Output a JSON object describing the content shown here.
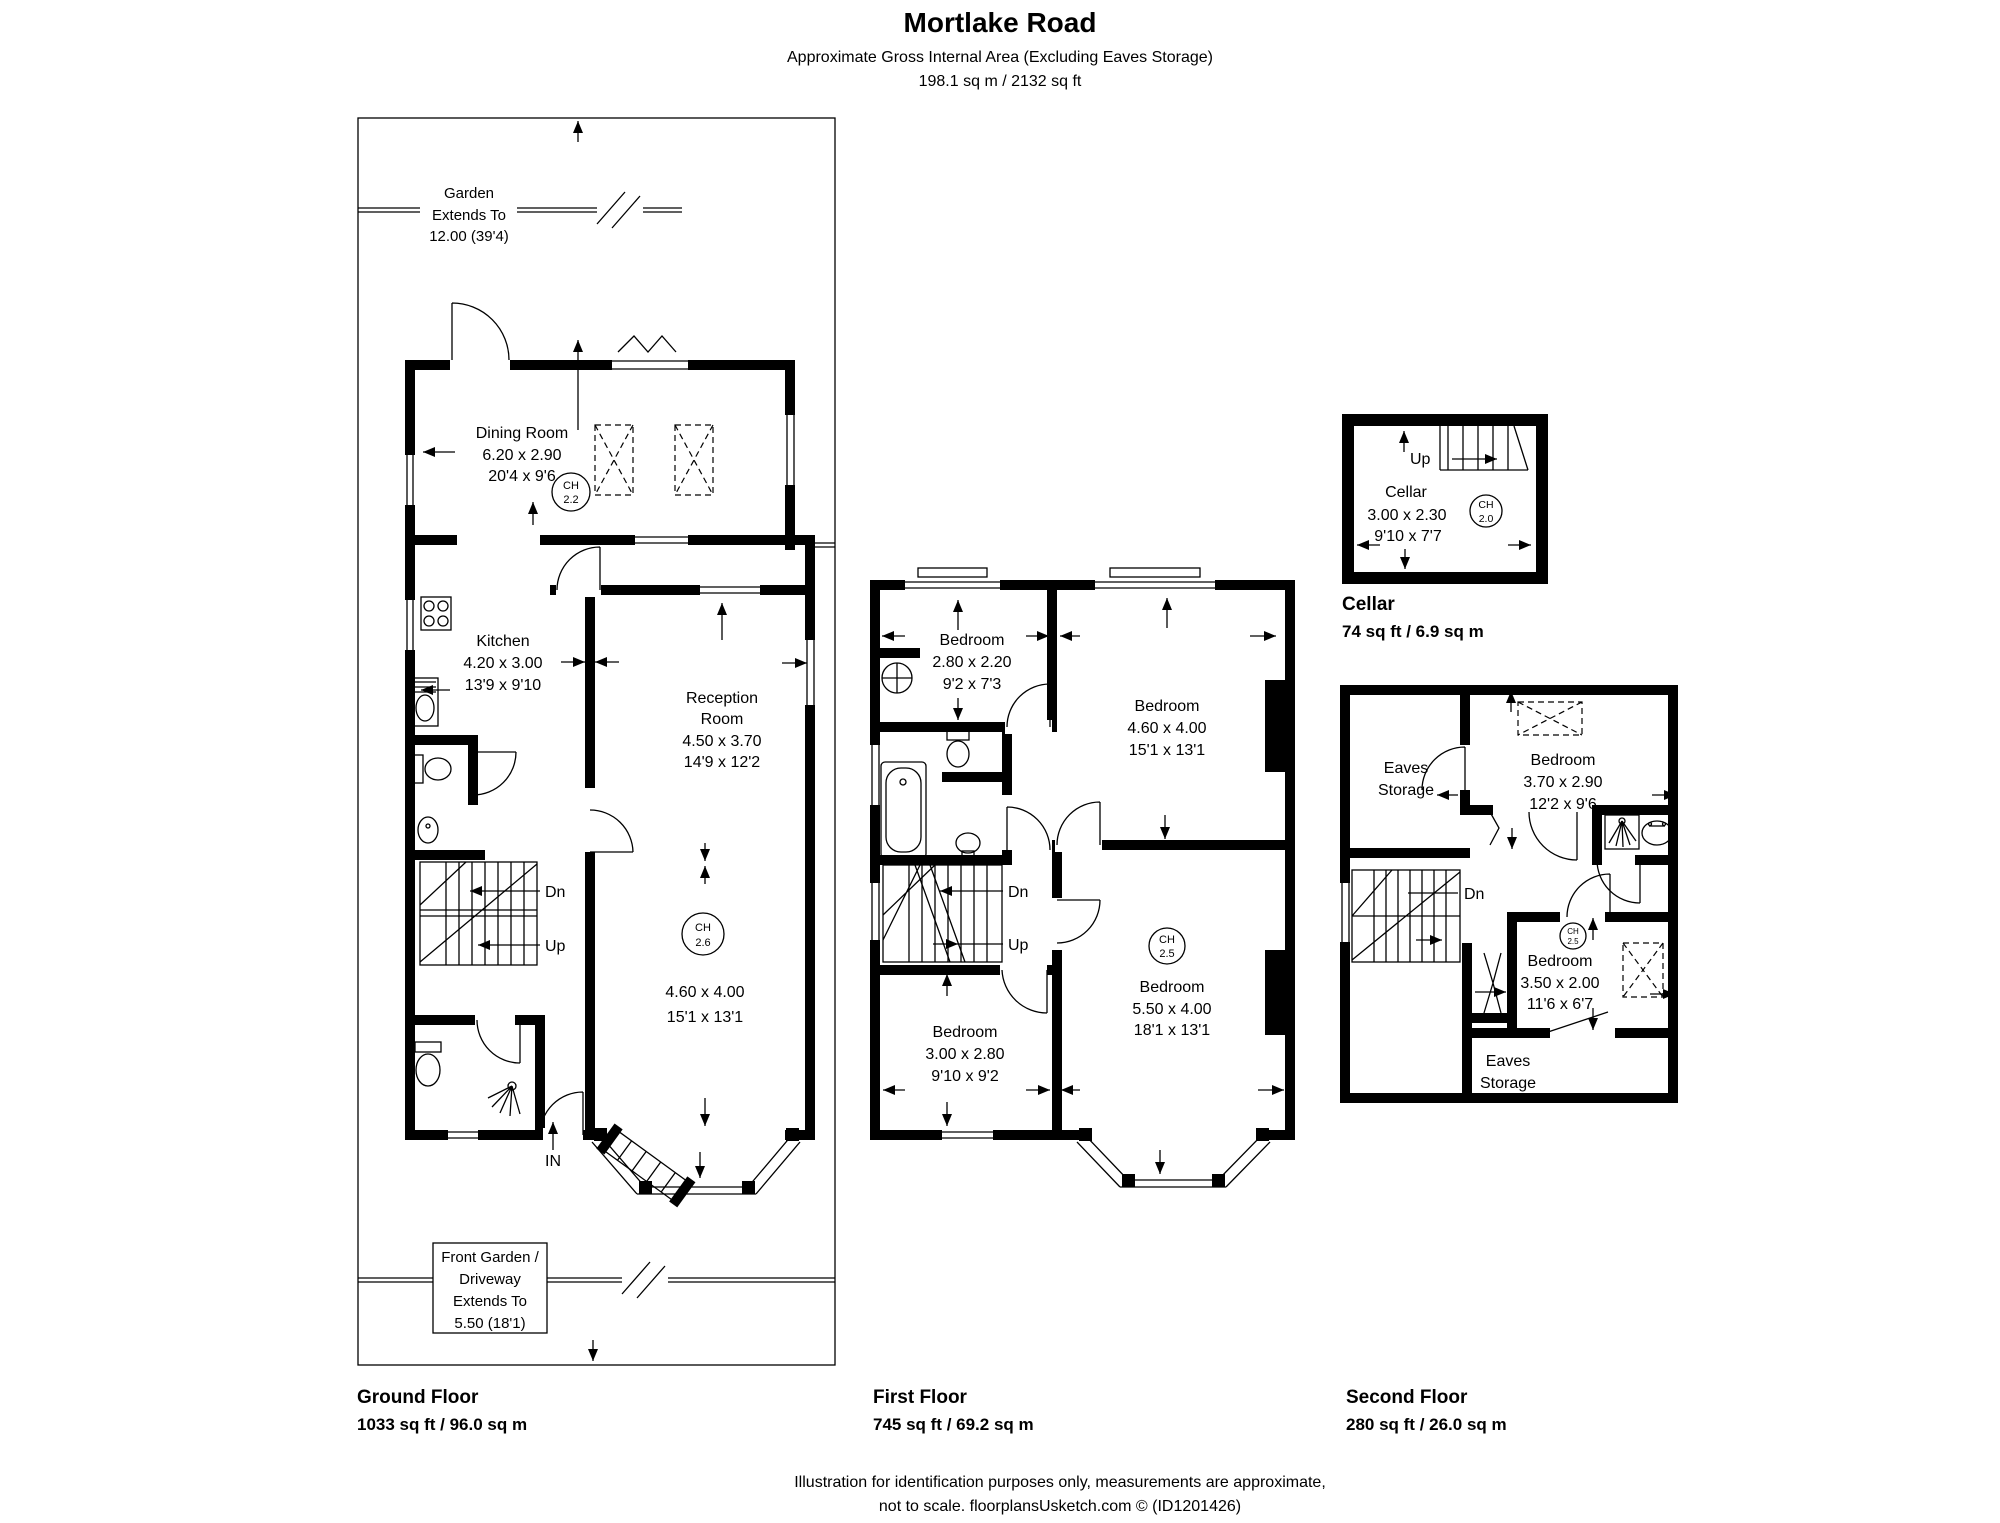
{
  "header": {
    "title": "Mortlake Road",
    "subtitle": "Approximate Gross Internal Area (Excluding Eaves Storage)",
    "area": "198.1 sq m / 2132 sq ft"
  },
  "colors": {
    "ink": "#000000",
    "paper": "#ffffff"
  },
  "ground": {
    "garden_note": {
      "l1": "Garden",
      "l2": "Extends To",
      "l3": "12.00 (39'4)"
    },
    "front_note": {
      "l1": "Front Garden /",
      "l2": "Driveway",
      "l3": "Extends To",
      "l4": "5.50 (18'1)"
    },
    "dining": {
      "name": "Dining Room",
      "metric": "6.20 x 2.90",
      "imperial": "20'4 x 9'6",
      "ch_label": "CH",
      "ch_value": "2.2"
    },
    "kitchen": {
      "name": "Kitchen",
      "metric": "4.20 x 3.00",
      "imperial": "13'9 x 9'10"
    },
    "reception": {
      "name_l1": "Reception",
      "name_l2": "Room",
      "metric": "4.50 x 3.70",
      "imperial": "14'9 x 12'2",
      "ch_label": "CH",
      "ch_value": "2.6",
      "metric2": "4.60 x 4.00",
      "imperial2": "15'1 x 13'1"
    },
    "stairs": {
      "down": "Dn",
      "up": "Up"
    },
    "entrance_label": "IN",
    "label": "Ground Floor",
    "area": "1033 sq ft / 96.0 sq m"
  },
  "first": {
    "bedroom_small": {
      "name": "Bedroom",
      "metric": "2.80 x 2.20",
      "imperial": "9'2 x 7'3"
    },
    "bedroom_rear": {
      "name": "Bedroom",
      "metric": "4.60 x 4.00",
      "imperial": "15'1 x 13'1"
    },
    "bedroom_mid": {
      "name": "Bedroom",
      "metric": "3.00 x 2.80",
      "imperial": "9'10 x 9'2"
    },
    "bedroom_front": {
      "name": "Bedroom",
      "metric": "5.50 x 4.00",
      "imperial": "18'1 x 13'1",
      "ch_label": "CH",
      "ch_value": "2.5"
    },
    "stairs": {
      "down": "Dn",
      "up": "Up"
    },
    "label": "First Floor",
    "area": "745 sq ft / 69.2 sq m"
  },
  "cellar": {
    "room": {
      "name": "Cellar",
      "metric": "3.00 x 2.30",
      "imperial": "9'10 x 7'7",
      "ch_label": "CH",
      "ch_value": "2.0"
    },
    "stairs": {
      "up": "Up"
    },
    "label": "Cellar",
    "area": "74 sq ft / 6.9 sq m"
  },
  "second": {
    "eaves_top": {
      "l1": "Eaves",
      "l2": "Storage"
    },
    "bedroom_rear": {
      "name": "Bedroom",
      "metric": "3.70 x 2.90",
      "imperial": "12'2 x 9'6"
    },
    "bedroom_front": {
      "name": "Bedroom",
      "metric": "3.50 x 2.00",
      "imperial": "11'6 x 6'7",
      "ch_label": "CH",
      "ch_value": "2.5"
    },
    "eaves_bottom": {
      "l1": "Eaves",
      "l2": "Storage"
    },
    "stairs": {
      "down": "Dn"
    },
    "label": "Second Floor",
    "area": "280 sq ft / 26.0 sq m"
  },
  "footer": {
    "line1": "Illustration for identification purposes only, measurements are approximate,",
    "line2": "not to scale. floorplansUsketch.com © (ID1201426)"
  }
}
